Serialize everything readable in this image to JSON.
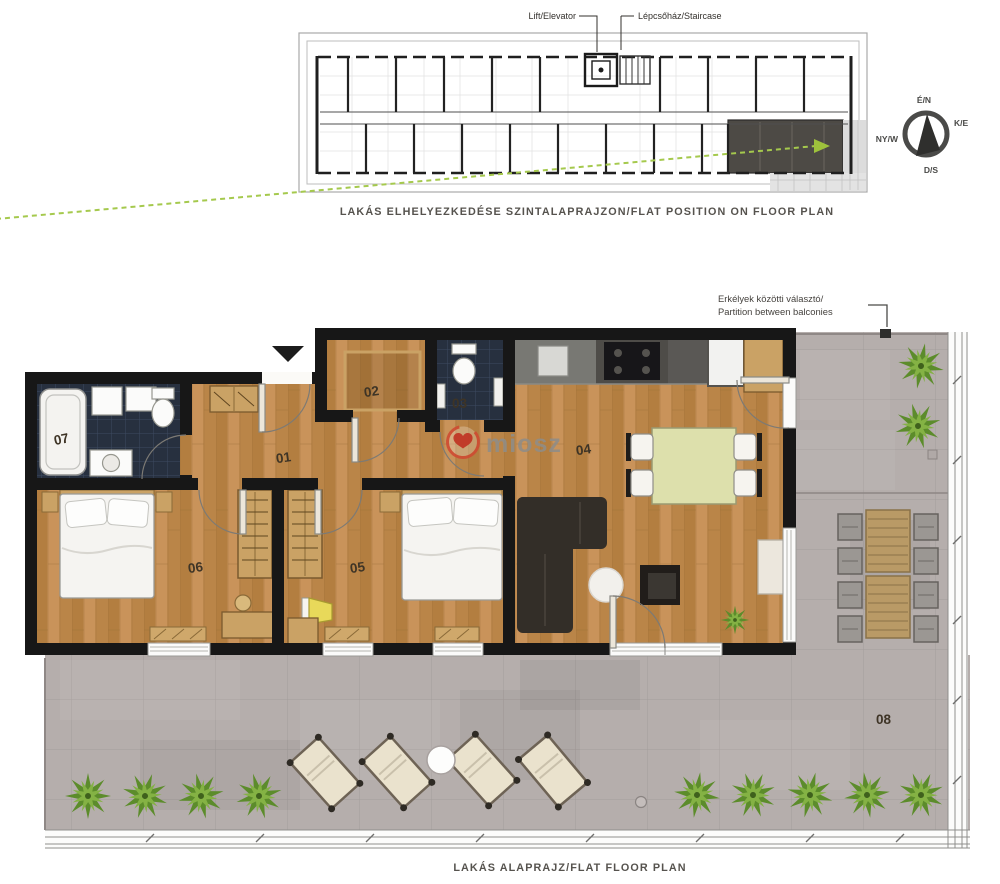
{
  "overview": {
    "lift_label": "Lift/Elevator",
    "staircase_label": "Lépcsőház/Staircase",
    "caption": "LAKÁS ELHELYEZKEDÉSE SZINTALAPRAJZON/FLAT POSITION ON FLOOR PLAN",
    "compass": {
      "north": "É/N",
      "east": "K/E",
      "south": "D/S",
      "west": "NY/W"
    }
  },
  "flat": {
    "balcony_note": {
      "line1": "Erkélyek közötti választó/",
      "line2": "Partition between balconies"
    },
    "room_labels": {
      "r01": "01",
      "r02": "02",
      "r03": "03",
      "r04": "04",
      "r05": "05",
      "r06": "06",
      "r07": "07",
      "r08": "08"
    },
    "caption": "LAKÁS ALAPRAJZ/FLAT FLOOR PLAN"
  },
  "watermark": {
    "text": "miosz"
  },
  "colors": {
    "wood": "#bf8a4e",
    "dark_tile": "#27303f",
    "terrace_gray": "#b5aeac",
    "plant_green": "#7fae3d",
    "highlight_flat": "#4d4a45",
    "guide_green": "#a5c94d",
    "watermark_red": "#c9402e"
  }
}
